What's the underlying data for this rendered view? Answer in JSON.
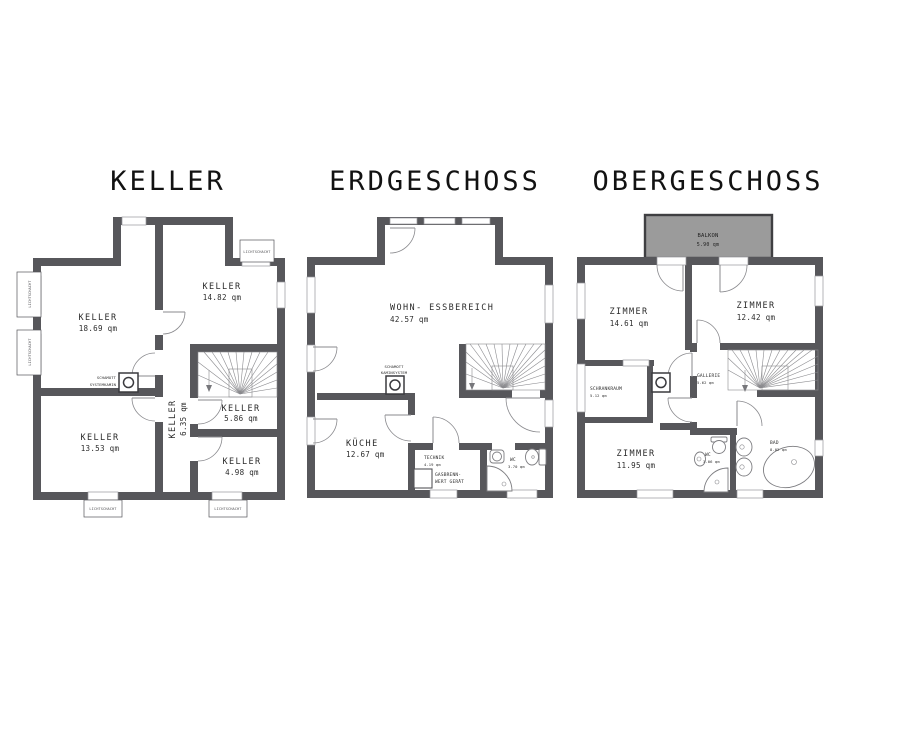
{
  "colors": {
    "background": "#ffffff",
    "wall": "#57575b",
    "balcony_fill": "#9b9b9b",
    "line": "#8a8a8e",
    "text": "#2b2b2b",
    "title": "#121212"
  },
  "floors": {
    "keller": {
      "title": "KELLER",
      "light_shaft": "LICHTSCHACHT",
      "chimney": {
        "line1": "SCHAMOTT",
        "line2": "SYSTEMKAMIN"
      },
      "rooms": [
        {
          "name": "KELLER",
          "area": "18.69 qm"
        },
        {
          "name": "KELLER",
          "area": "14.82 qm"
        },
        {
          "name": "KELLER",
          "area": "13.53 qm"
        },
        {
          "name": "KELLER",
          "area": "6.35 qm"
        },
        {
          "name": "KELLER",
          "area": "5.86 qm"
        },
        {
          "name": "KELLER",
          "area": "4.98 qm"
        }
      ]
    },
    "erdgeschoss": {
      "title": "ERDGESCHOSS",
      "chimney": {
        "line1": "SCHAMOTT",
        "line2": "KAMINSYSTEM"
      },
      "boiler": {
        "line1": "GASBRENN-",
        "line2": "WERT GERÄT"
      },
      "rooms": [
        {
          "name": "WOHN- ESSBEREICH",
          "area": "42.57 qm"
        },
        {
          "name": "KÜCHE",
          "area": "12.67 qm"
        },
        {
          "name": "TECHNIK",
          "area": "4.19 qm"
        },
        {
          "name": "WC",
          "area": "3.70 qm"
        }
      ]
    },
    "obergeschoss": {
      "title": "OBERGESCHOSS",
      "balcony": {
        "name": "BALKON",
        "area": "5.90 qm"
      },
      "rooms": [
        {
          "name": "ZIMMER",
          "area": "14.61 qm"
        },
        {
          "name": "ZIMMER",
          "area": "12.42 qm"
        },
        {
          "name": "SCHRANKRAUM",
          "area": "5.12 qm"
        },
        {
          "name": "GALLERIE",
          "area": "5.62 qm"
        },
        {
          "name": "ZIMMER",
          "area": "11.95 qm"
        },
        {
          "name": "WC",
          "area": "3.06 qm"
        },
        {
          "name": "BAD",
          "area": "8.02 qm"
        }
      ]
    }
  }
}
